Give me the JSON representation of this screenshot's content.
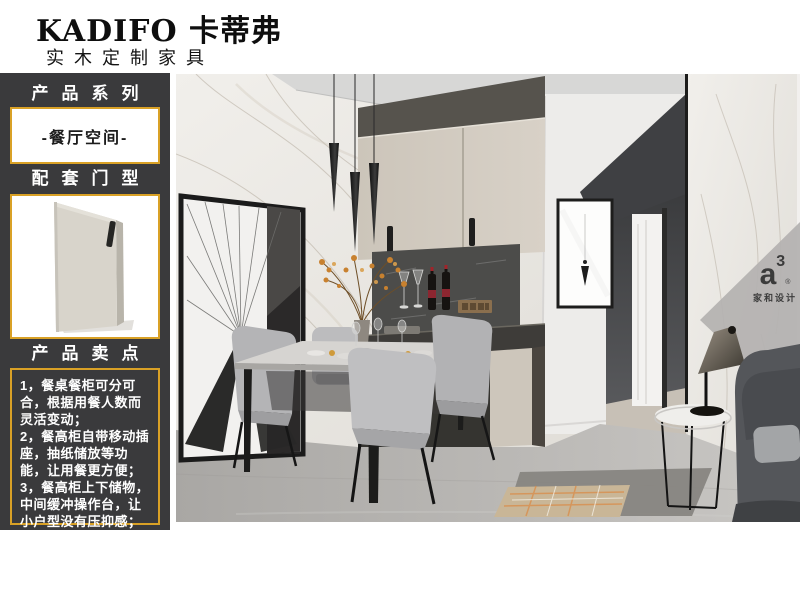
{
  "brand": {
    "name": "KADIFO 卡蒂弗",
    "tagline": "实木定制家具"
  },
  "sidebar": {
    "section1": {
      "title": "产品系列",
      "value": "-餐厅空间-"
    },
    "section2": {
      "title": "配套门型"
    },
    "section3": {
      "title": "产品卖点",
      "points": [
        "1，餐桌餐柜可分可合，根据用餐人数而灵活变动；",
        "2，餐高柜自带移动插座，抽纸储放等功能，让用餐更方便；",
        "3，餐高柜上下储物，中间缓冲操作台，让小户型没有压抑感；"
      ]
    }
  },
  "watermark": {
    "letter": "a",
    "exponent": "3",
    "registered": "®",
    "caption": "家和设计"
  },
  "colors": {
    "sidebar_bg": "#3a3a3c",
    "accent_gold": "#d9a126",
    "header_text": "#0e0e0e"
  }
}
